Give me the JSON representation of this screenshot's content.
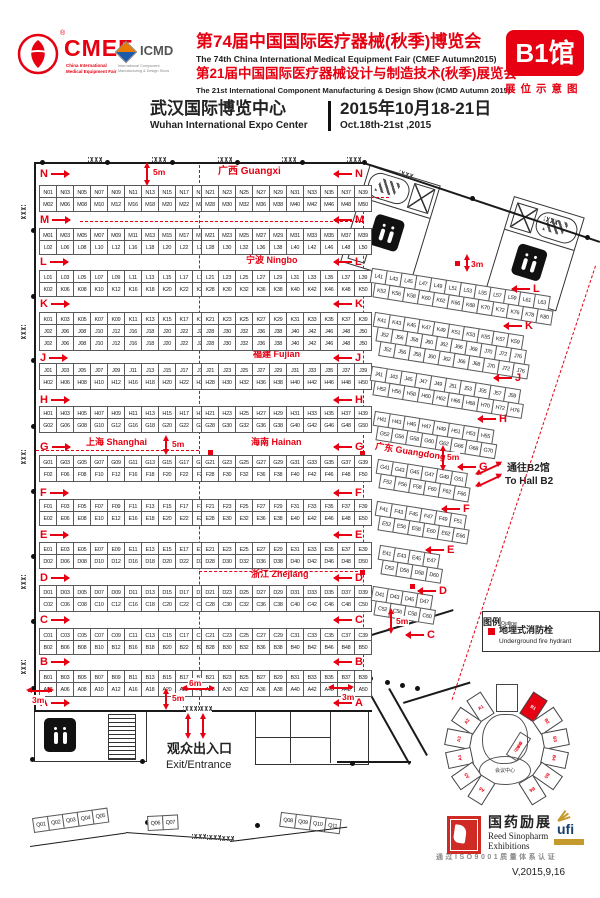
{
  "header": {
    "cmef_logo": "CMEF",
    "cmef_reg": "®",
    "cmef_sub1": "China International",
    "cmef_sub2": "Medical Equipment Fair",
    "icmd_logo": "ICMD",
    "icmd_sub1": "International Component",
    "icmd_sub2": "Manufacturing & Design Show",
    "title_cn_1": "第74届中国国际医疗器械(秋季)博览会",
    "title_en_1": "The 74th China International Medical Equipment Fair (CMEF Autumn2015)",
    "title_cn_2": "第21届中国国际医疗器械设计与制造技术(秋季)展览会",
    "title_en_2": "The 21st International Component Manufacturing & Design Show (ICMD Autumn 2015)",
    "hall_badge": "B1馆",
    "hall_badge_sub": "展位示意图",
    "venue_cn": "武汉国际博览中心",
    "venue_en": "Wuhan International Expo Center",
    "date_cn": "2015年10月18-21日",
    "date_en": "Oct.18th-21st ,2015"
  },
  "map": {
    "regions": {
      "guangxi": "广西 Guangxi",
      "ningbo": "宁波 Ningbo",
      "fujian": "福建 Fujian",
      "shanghai": "上海 Shanghai",
      "hainan": "海南 Hainan",
      "zhejiang": "浙江 Zhejiang",
      "guangdong": "广东 Guangdong"
    },
    "aisles": [
      "N",
      "M",
      "L",
      "K",
      "J",
      "H",
      "G",
      "F",
      "E",
      "D",
      "C",
      "B",
      "A"
    ],
    "diag_aisles": [
      "L",
      "K",
      "J",
      "H",
      "G",
      "F",
      "E",
      "D",
      "C"
    ],
    "dimension_markers": [
      "5m",
      "5m",
      "5m",
      "3m",
      "6m",
      "3m",
      "5m",
      "5m",
      "3m"
    ],
    "bands": [
      {
        "letter": "N",
        "lines": [
          "N01 N03 N05 N07 N09 N11 N13 N15 N17 N19 | N21 N23 N25 N27 N29 N31 N33 N35 N37 N39",
          "M02 M06 M08 M10 M12 M16 M18 M20 M22 M26 | M28 M30 M32 M36 M38 M40 M42 M46 M48 M50"
        ]
      },
      {
        "letter": "M",
        "lines": [
          "M01 M03 M05 M07 M09 M11 M13 M15 M17 M19 | M21 M23 M25 M27 M29 M31 M33 M35 M37 M39",
          "L02 L06 L08 L10 L12 L16 L18 L20 L22 L26 | L28 L30 L32 L36 L38 L40 L42 L46 L48 L50"
        ]
      },
      {
        "letter": "L",
        "lines": [
          "L01 L03 L05 L07 L09 L11 L13 L15 L17 L19 | L21 L23 L25 L27 L29 L31 L33 L35 L37 L39",
          "K02 K06 K08 K10 K12 K16 K18 K20 K22 K26 | K28 K30 K32 K36 K38 K40 K42 K46 K48 K50"
        ]
      },
      {
        "letter": "K",
        "lines": [
          "K01 K03 K05 K07 K09 K11 K13 K15 K17 K19 | K21 K23 K25 K27 K29 K31 K33 K35 K37 K39",
          "J02 J06 J08 J10 J12 J16 J18 J20 J22 J26 | J28 J30 J32 J36 J38 J40 J42 J46 J48 J50",
          "J02 J06 J08 J10 J12 J16 J18 J20 J22 J26 | J28 J30 J32 J36 J38 J40 J42 J46 J48 J50"
        ]
      },
      {
        "letter": "J",
        "lines": [
          "J01 J03 J05 J07 J09 J11 J13 J15 J17 J19 | J21 J23 J25 J27 J29 J31 J33 J35 J37 J39",
          "H02 H06 H08 H10 H12 H16 H18 H20 H22 H26 | H28 H30 H32 H36 H38 H40 H42 H46 H48 H50"
        ]
      },
      {
        "letter": "H",
        "lines": [
          "H01 H03 H05 H07 H09 H11 H13 H15 H17 H19 | H21 H23 H25 H27 H29 H31 H33 H35 H37 H39",
          "G02 G06 G08 G10 G12 G16 G18 G20 G22 G26 | G28 G30 G32 G36 G38 G40 G42 G46 G48 G50"
        ]
      },
      {
        "letter": "G",
        "lines": [
          "G01 G03 G05 G07 G09 G11 G13 G15 G17 G19 | G21 G23 G25 G27 G29 G31 G33 G35 G37 G39",
          "F02 F06 F08 F10 F12 F16 F18 F20 F22 F26 | F28 F30 F32 F36 F38 F40 F42 F46 F48 F50"
        ]
      },
      {
        "letter": "F",
        "lines": [
          "F01 F03 F05 F07 F09 F11 F13 F15 F17 F19 | F21 F23 F25 F27 F29 F31 F33 F35 F37 F39",
          "E02 E06 E08 E10 E12 E16 E18 E20 E22 E26 | E28 E30 E32 E36 E38 E40 E42 E46 E48 E50"
        ]
      },
      {
        "letter": "E",
        "lines": [
          "E01 E03 E05 E07 E09 E11 E13 E15 E17 E19 | E21 E23 E25 E27 E29 E31 E33 E35 E37 E39",
          "D02 D06 D08 D10 D12 D16 D18 D20 D22 D26 | D28 D30 D32 D36 D38 D40 D42 D46 D48 D50"
        ]
      },
      {
        "letter": "D",
        "lines": [
          "D01 D03 D05 D07 D09 D11 D13 D15 D17 D19 | D21 D23 D25 D27 D29 D31 D33 D35 D37 D39",
          "C02 C06 C08 C10 C12 C16 C18 C20 C22 C26 | C28 C30 C32 C36 C38 C40 C42 C46 C48 C50"
        ]
      },
      {
        "letter": "C",
        "lines": [
          "C01 C03 C05 C07 C09 C11 C13 C15 C17 C19 | C21 C23 C25 C27 C29 C31 C33 C35 C37 C39",
          "B02 B06 B08 B10 B12 B16 B18 B20 B22 B26 | B28 B30 B32 B36 B38 B40 B42 B46 B48 B50"
        ]
      },
      {
        "letter": "B",
        "lines": [
          "B01 B03 B05 B07 B09 B11 B13 B15 B17 B19 | B21 B23 B25 B27 B29 B31 B33 B35 B37 B39",
          "A02 A06 A08 A10 A12 A16 A18 A20 A22 A26 | A28 A30 A32 A36 A38 A40 A42 A46 A48 A50"
        ]
      }
    ],
    "diagonal_bands": [
      {
        "letter": "L",
        "lines": [
          "L41 L43 L45 L47 L49 L51 L53 L55 L57 L59 L61 L63",
          "K52 K56 K58 K60 K62 K66 K68 K70 K72 K76 K78 K80"
        ]
      },
      {
        "letter": "K",
        "lines": [
          "K41 K43 K45 K47 K49 K51 K53 K55 K57 K59",
          "J52 J56 J58 J60 J62 J66 J68 J70 J72 J76",
          "J52 J56 J58 J60 J62 J66 J68 J70 J72 J76"
        ]
      },
      {
        "letter": "J",
        "lines": [
          "J41 J43 J45 J47 J49 J51 J53 J55 J57 J59",
          "H52 H56 H58 H60 H62 H66 H68 H70 H72 H76"
        ]
      },
      {
        "letter": "H",
        "lines": [
          "H41 H43 H45 H47 H49 H51 H53 H55",
          "G52 G56 G58 G60 G62 G66 G68 G70"
        ]
      },
      {
        "letter": "G",
        "lines": [
          "G41 G43 G45 G47 G49 G51",
          "F52 F56 F58 F60 F62 F66"
        ]
      },
      {
        "letter": "F",
        "lines": [
          "F41 F43 F45 F47 F49 F51",
          "E52 E56 E58 E60 E62 E66"
        ]
      },
      {
        "letter": "E",
        "lines": [
          "E41 E43 E45 E47",
          "D52 D56 D58 D60"
        ]
      },
      {
        "letter": "D",
        "lines": [
          "D41 D43 D45 D47",
          "C52 C56 C58 C60"
        ]
      }
    ],
    "q_booths": [
      [
        "Q01",
        "Q02",
        "Q03",
        "Q04",
        "Q05"
      ],
      [
        "Q06",
        "Q07"
      ],
      [
        "Q08",
        "Q09",
        "Q10",
        "Q11"
      ]
    ],
    "exit_cn": "观众出入口",
    "exit_en": "Exit/Entrance",
    "to_b2_cn": "通往B2馆",
    "to_b2_en": "To Hall B2",
    "legend": {
      "title": "图例",
      "title_en": "Outline",
      "item_cn": "地埋式消防栓",
      "item_en": "Underground fire hydrant"
    },
    "minimap": {
      "halls_left": [
        "A1",
        "A2",
        "A3",
        "A4",
        "A5",
        "A6"
      ],
      "halls_right": [
        "B1",
        "B2",
        "B3",
        "B4",
        "B5",
        "B6"
      ],
      "highlight": "B1",
      "center_label": "会议中心",
      "lobby_label": "登录厅"
    }
  },
  "footer": {
    "organizer_cn": "国药励展",
    "organizer_en_1": "Reed Sinopharm",
    "organizer_en_2": "Exhibitions",
    "ufi": "ufi",
    "ufi_member": "Member",
    "iso_text": "通过ISO9001质量体系认证",
    "version": "V,2015,9,16"
  }
}
